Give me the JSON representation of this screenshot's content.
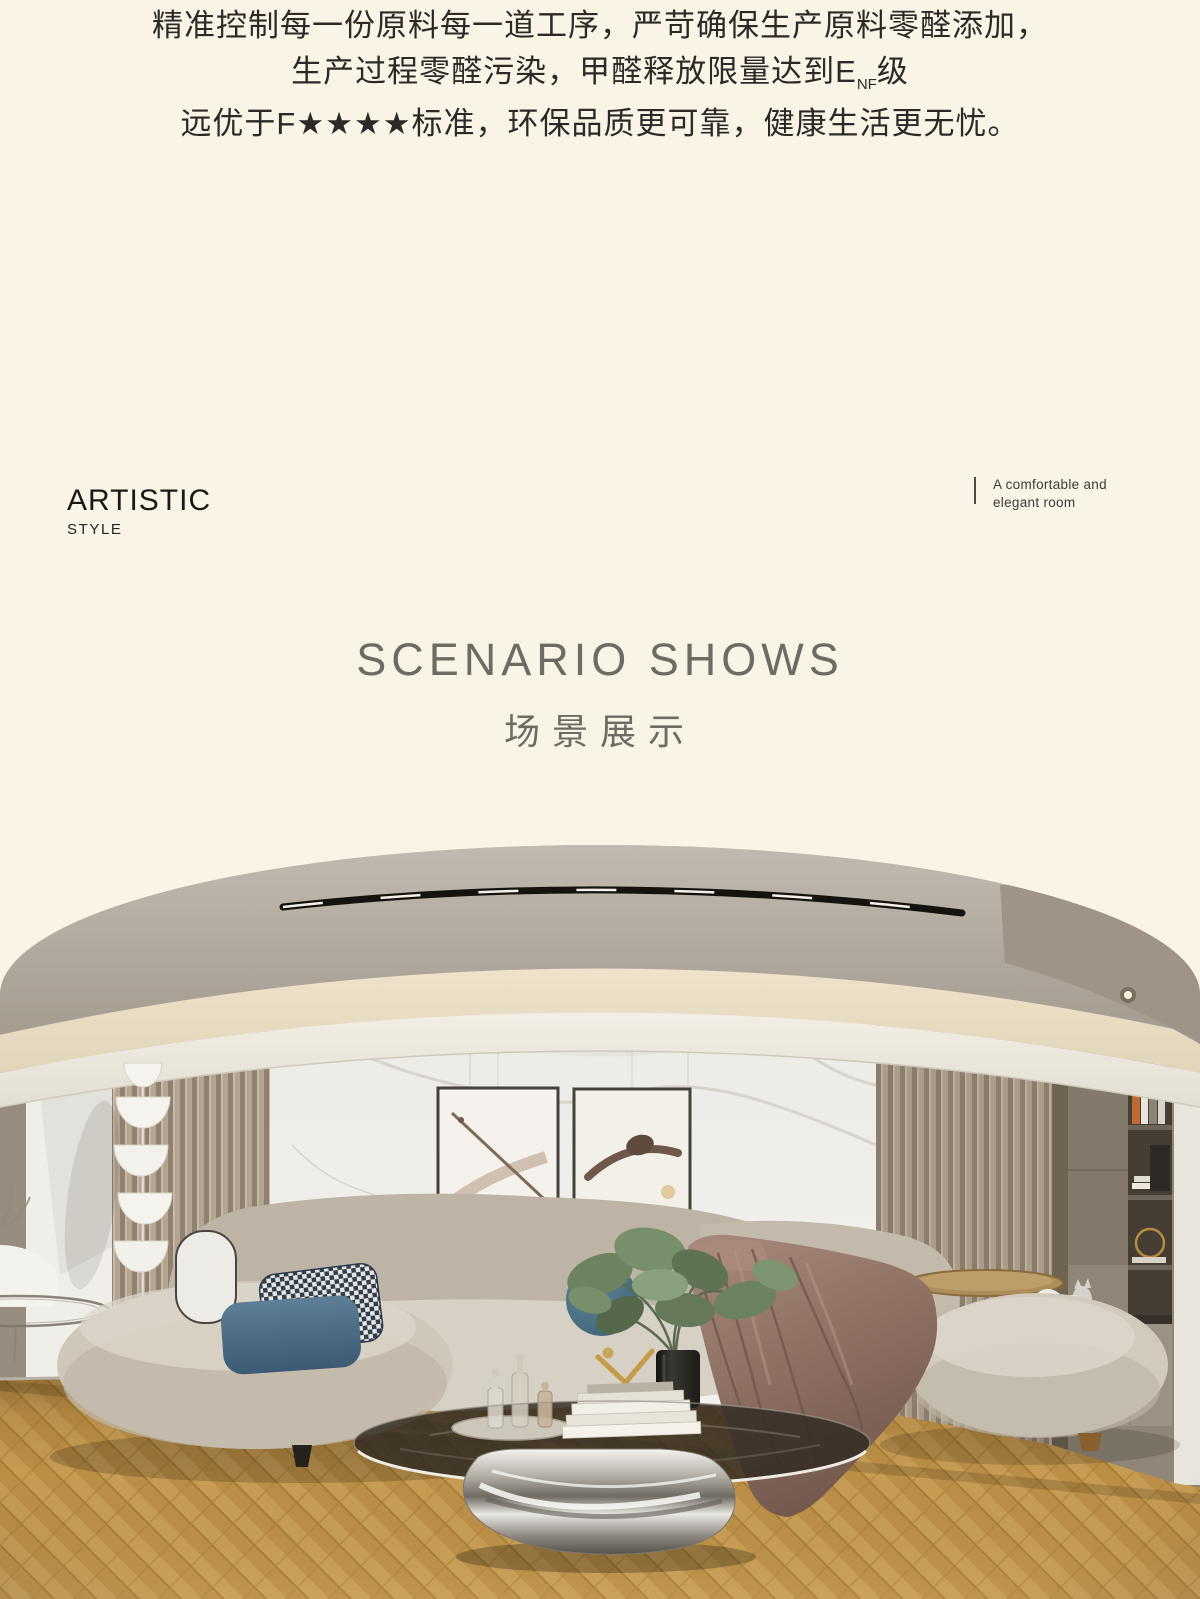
{
  "page": {
    "background": "#faf4e6",
    "width": 1200,
    "height": 1599
  },
  "intro": {
    "line1": "精准控制每一份原料每一道工序，严苛确保生产原料零醛添加，",
    "line2_pre": "生产过程零醛污染，甲醛释放限量达到E",
    "line2_sub": "NF",
    "line2_post": "级",
    "line3": "远优于F★★★★标准，环保品质更可靠，健康生活更无忧。"
  },
  "style_block": {
    "title": "ARTISTIC",
    "subtitle": "STYLE"
  },
  "side_note": {
    "line1": "A comfortable and",
    "line2": "elegant room"
  },
  "section": {
    "title_en": "SCENARIO SHOWS",
    "title_cn": "场景展示"
  },
  "hero": {
    "description": "Modern beige living room: curved boucle sectional sofa with houndstooth and blue pillows, marble feature wall with two framed artworks, fluted wood panels, sculptural stacked-bowl floor lamp, round glass coffee table with chrome base, brown satin throw, round pouf, built-in shelving and herringbone oak floor"
  },
  "colors": {
    "cream_bg": "#faf4e6",
    "text_dark": "#2b2a28",
    "muted_title": "#6f6b63",
    "ceiling": "#b5ada3",
    "floor_wood": "#bd9148",
    "sofa_beige": "#cdc5b8"
  }
}
